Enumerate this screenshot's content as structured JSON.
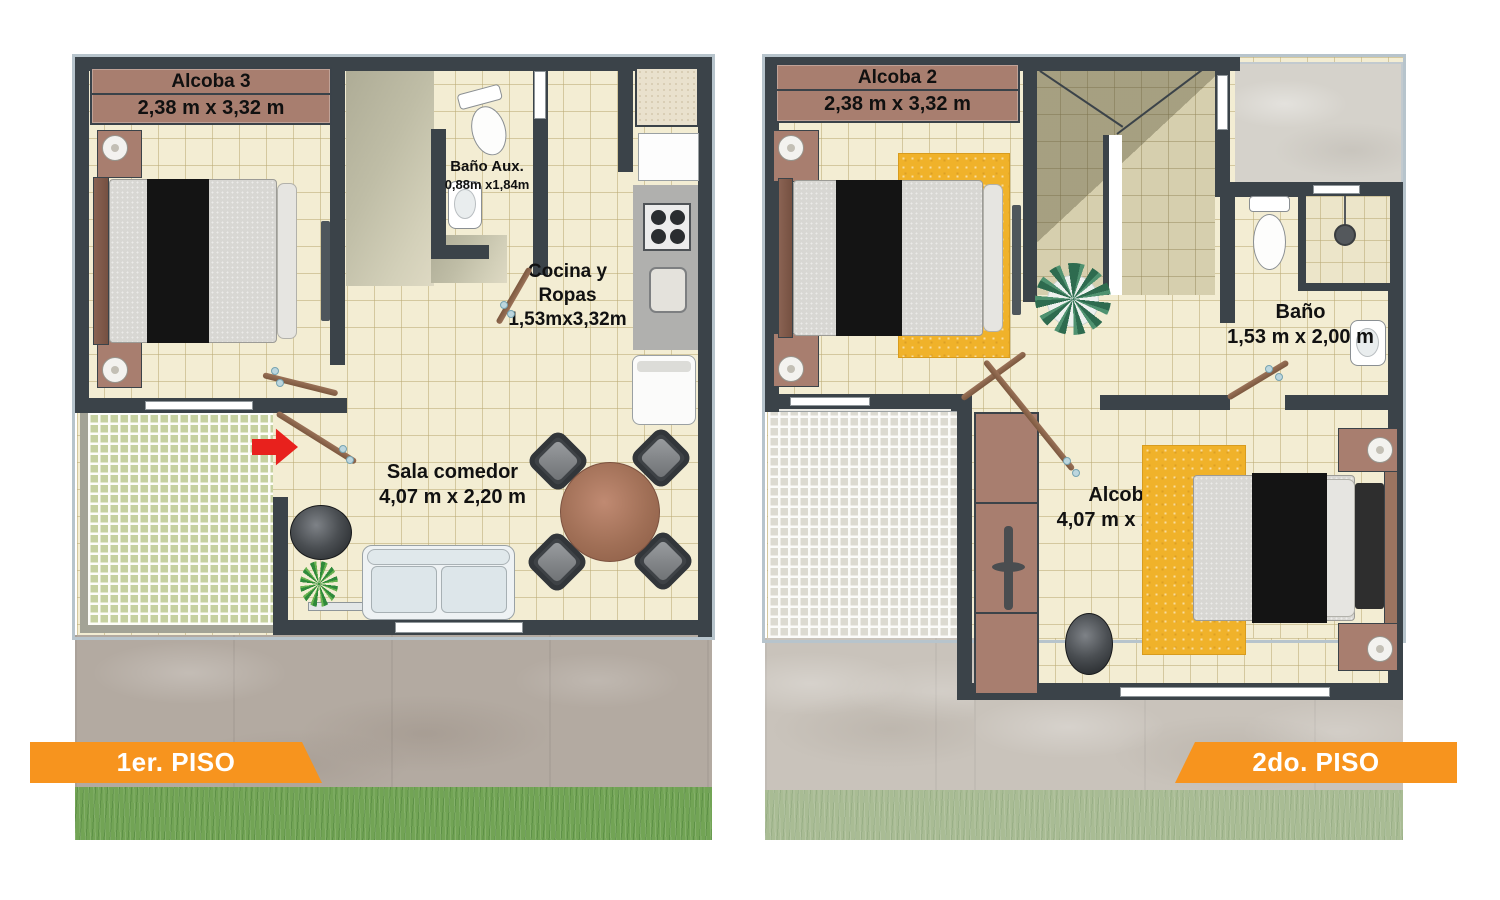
{
  "floor1": {
    "banner": "1er. PISO",
    "rooms": {
      "alcoba3": {
        "name": "Alcoba 3",
        "dims": "2,38 m x 3,32 m"
      },
      "bano_aux": {
        "name": "Baño Aux.",
        "dims": "0,88m x1,84m"
      },
      "cocina": {
        "name_line1": "Cocina y",
        "name_line2": "Ropas",
        "dims": "1,53mx3,32m"
      },
      "sala": {
        "name": "Sala comedor",
        "dims": "4,07 m x 2,20 m"
      }
    }
  },
  "floor2": {
    "banner": "2do. PISO",
    "rooms": {
      "alcoba2": {
        "name": "Alcoba 2",
        "dims": "2,38 m x 3,32 m"
      },
      "bano": {
        "name": "Baño",
        "dims": "1,53 m x 2,00 m"
      },
      "alcoba1": {
        "name": "Alcoba 1",
        "dims": "4,07 m x 2,68 m"
      }
    }
  },
  "colors": {
    "banner_orange": "#F7941E",
    "wall": "#3B4349",
    "room_header_brown": "#A87E6F",
    "floor_tile_cream": "#F3EDD3",
    "rug_yellow": "#F0B22A",
    "entrance_arrow_red": "#E8211D",
    "patio_grid_green": "#C6D1A0",
    "grass_front": "#72A455",
    "grass_back": "#A9BC94"
  }
}
